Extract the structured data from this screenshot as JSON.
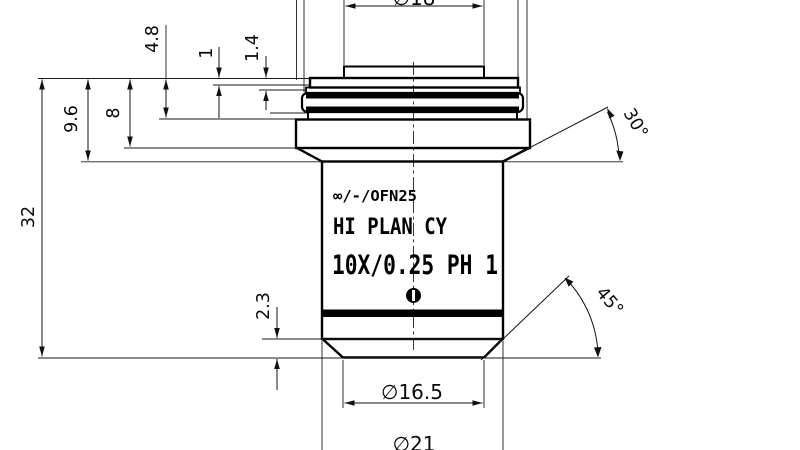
{
  "drawing": {
    "type": "technical-dimension-drawing",
    "subject": "microscope-objective",
    "colors": {
      "line": "#000000",
      "background": "#ffffff"
    },
    "markings": {
      "line1": "∞/-/OFN25",
      "line2": "HI PLAN CY",
      "line3": "10X/0.25 PH 1"
    },
    "dimensions": {
      "top_diameter": "∅18",
      "cap_step_height": "4.8",
      "ring_step_1": "1",
      "ring_step_2": "1.4",
      "shoulder_depth": "9.6",
      "flange_depth": "8",
      "overall_length": "32",
      "tip_chamfer_height": "2.3",
      "upper_chamfer_angle": "30°",
      "tip_chamfer_angle": "45°",
      "front_tip_diameter": "∅16.5",
      "lower_body_diameter": "∅21"
    }
  }
}
